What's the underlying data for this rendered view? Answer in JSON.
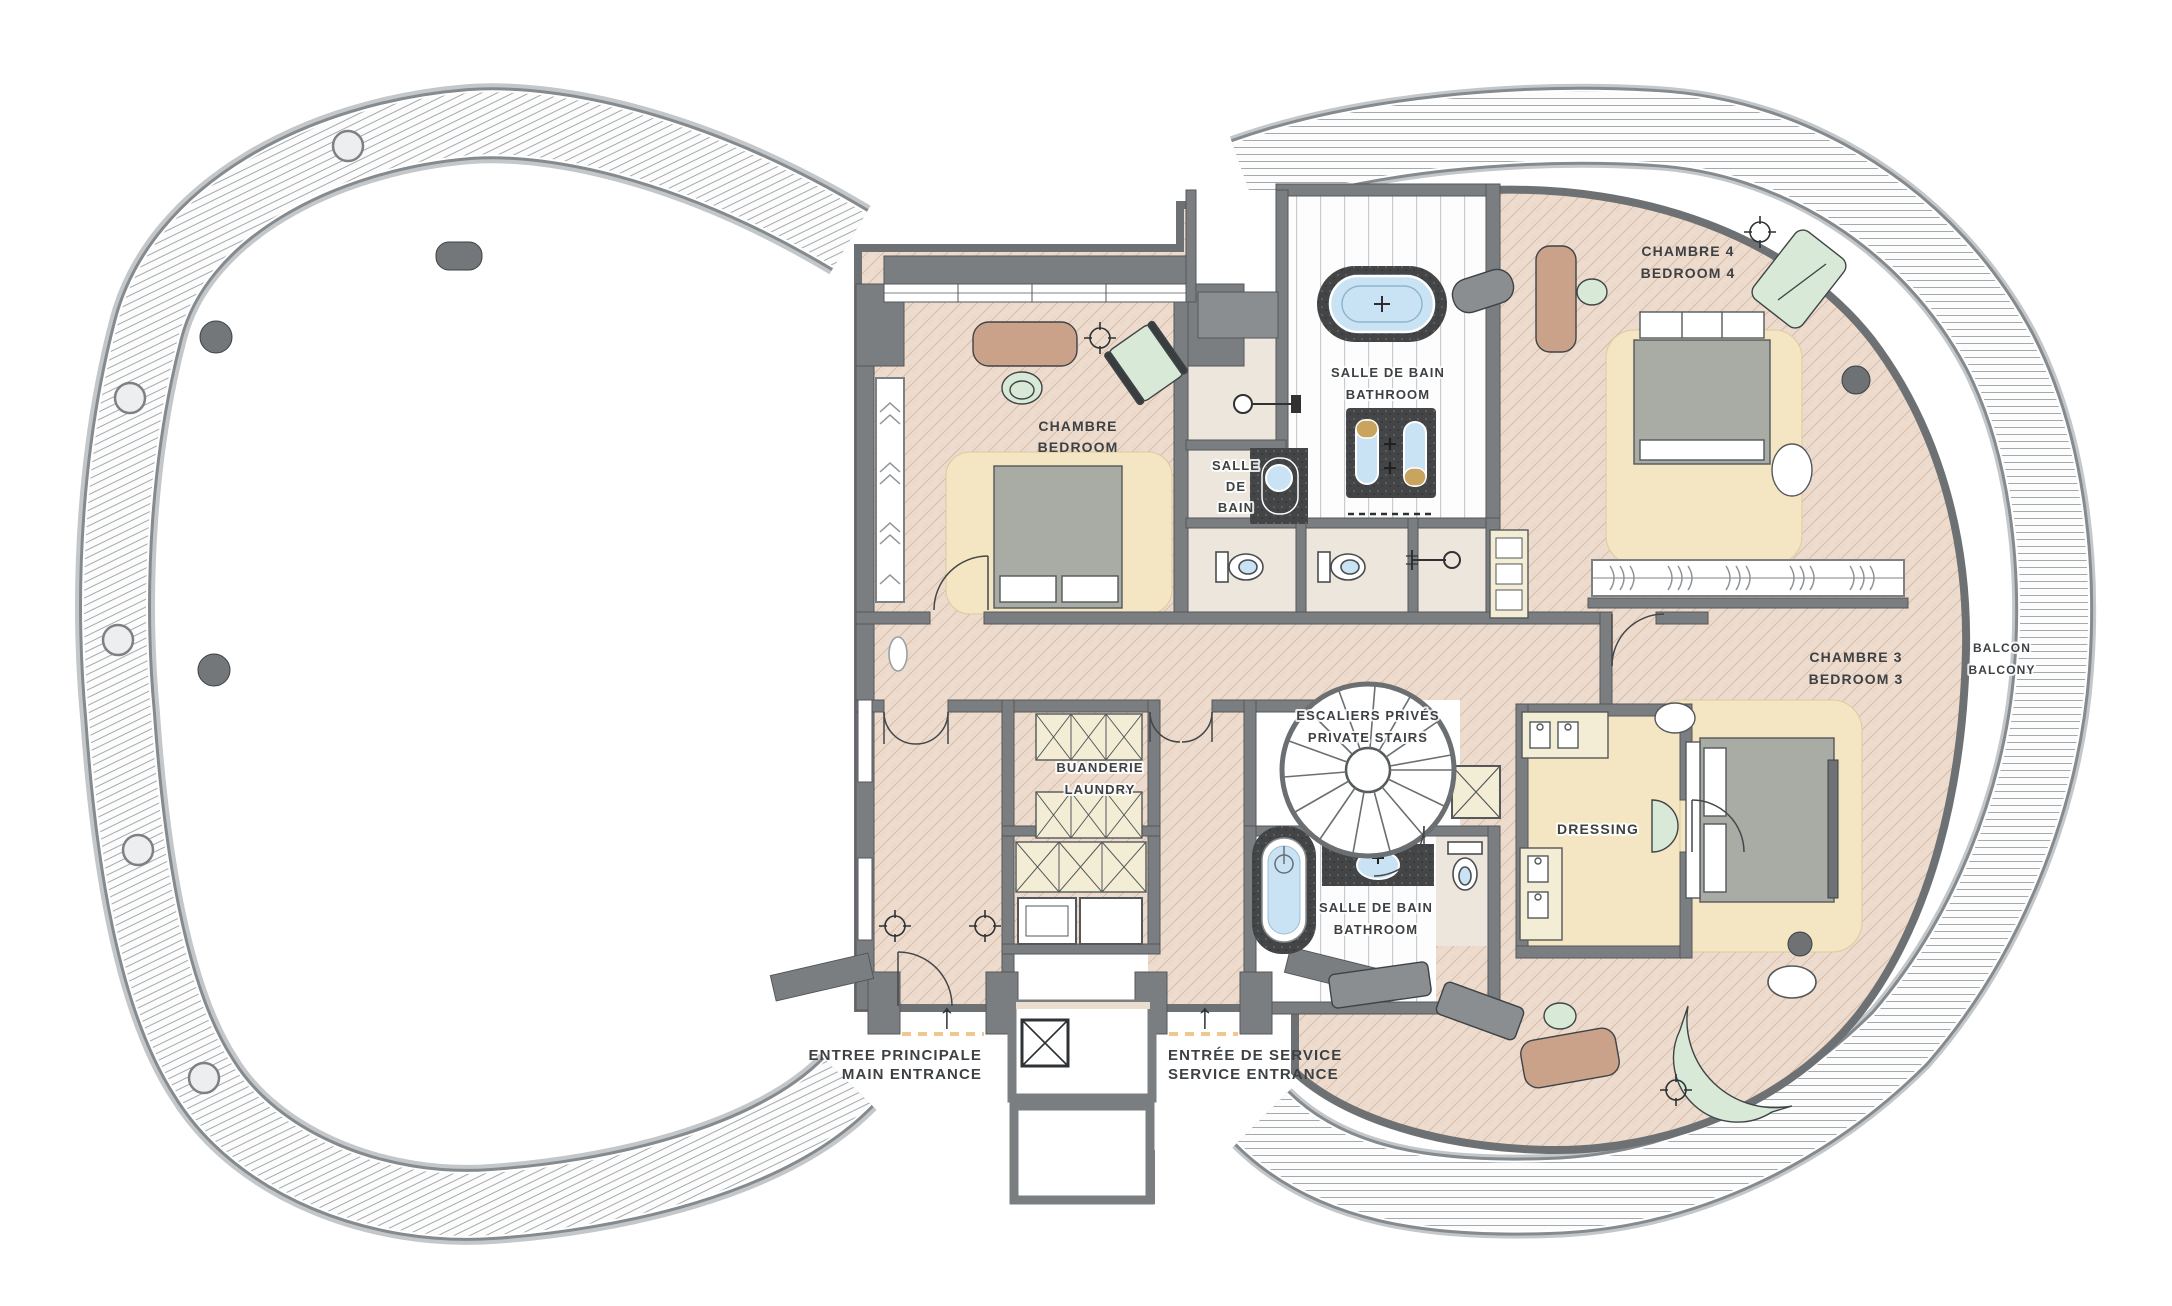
{
  "document": {
    "type": "floor-plan",
    "language": "fr-en"
  },
  "colors": {
    "wall": "#7b7e80",
    "label_text": "#3d4144",
    "floor_tan": "#eddcce",
    "rug_cream": "#f4e6c2",
    "bed_gray": "#a9aca5",
    "mint_green": "#d9e9d7",
    "wood_tan": "#c9a289",
    "water_blue": "#c9e2f4",
    "gold_basin": "#c9a45e",
    "dark_stone": "#434547",
    "closet_cream": "#f3edd6",
    "beige_floor": "#ece6dd",
    "threshold_dash": "#f2c78f",
    "bench_gray": "#8b8e90"
  },
  "icons": {
    "entrance_arrow": "↑"
  },
  "rooms": {
    "bedroom": {
      "fr": "CHAMBRE",
      "en": "BEDROOM"
    },
    "bathroom_small": {
      "line1": "SALLE",
      "line2": "DE",
      "line3": "BAIN"
    },
    "bathroom_top": {
      "fr": "SALLE DE BAIN",
      "en": "BATHROOM"
    },
    "bedroom4": {
      "fr": "CHAMBRE 4",
      "en": "BEDROOM 4"
    },
    "bedroom3": {
      "fr": "CHAMBRE 3",
      "en": "BEDROOM 3"
    },
    "stairs": {
      "fr": "ESCALIERS PRIVÉS",
      "en": "PRIVATE STAIRS"
    },
    "laundry": {
      "fr": "BUANDERIE",
      "en": "LAUNDRY"
    },
    "bathroom_bottom": {
      "fr": "SALLE DE BAIN",
      "en": "BATHROOM"
    },
    "dressing": {
      "label": "DRESSING"
    },
    "balcony": {
      "fr": "BALCON",
      "en": "BALCONY"
    }
  },
  "entrances": {
    "main": {
      "fr": "ENTREE PRINCIPALE",
      "en": "MAIN ENTRANCE"
    },
    "service": {
      "fr": "ENTRÉE DE SERVICE",
      "en": "SERVICE ENTRANCE"
    }
  }
}
